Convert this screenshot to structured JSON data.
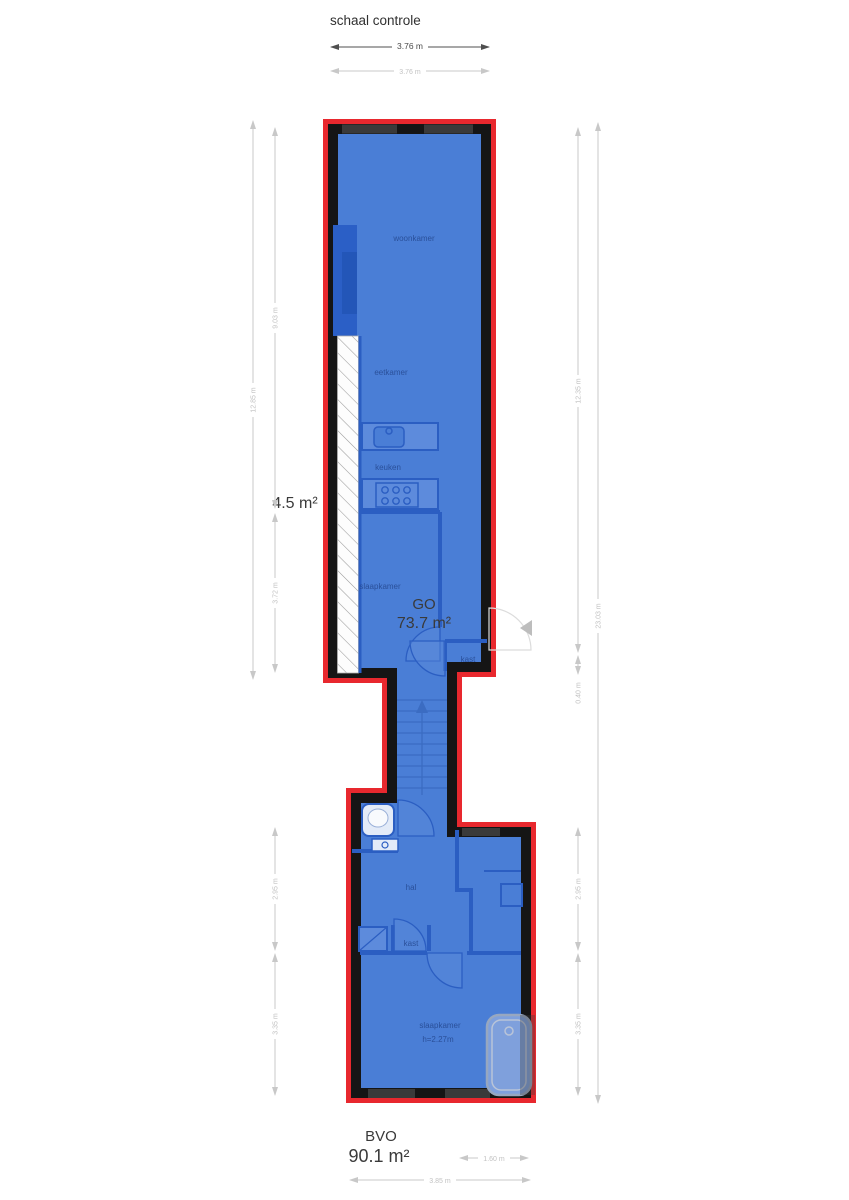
{
  "header": {
    "title": "schaal controle"
  },
  "areas": {
    "void_value": "4.5 m²",
    "go_label": "GO",
    "go_value": "73.7 m²",
    "bvo_label": "BVO",
    "bvo_value": "90.1 m²"
  },
  "rooms": {
    "woonkamer": "woonkamer",
    "eetkamer": "eetkamer",
    "keuken": "keuken",
    "slaapkamer_upper": "slaapkamer",
    "kast_upper": "kast",
    "hal": "hal",
    "kast_lower": "kast",
    "slaapkamer_lower": "slaapkamer",
    "slaapkamer_height": "h=2.27m"
  },
  "dims": {
    "top_primary": "3.76 m",
    "top_secondary": "3.76 m",
    "left_total": "12.85 m",
    "left_upper": "9.03 m",
    "left_lower": "3.72 m",
    "left_low_a": "2.95 m",
    "left_low_b": "3.35 m",
    "right_upper": "12.35 m",
    "right_small": "0.40 m",
    "right_total": "23.03 m",
    "right_low_a": "2.95 m",
    "right_low_b": "3.35 m",
    "bottom_small": "1.60 m",
    "bottom_total": "3.85 m"
  },
  "colors": {
    "outline_red": "#e8282e",
    "wall_black": "#151515",
    "floor_blue": "#4a7ed6",
    "interior_wall_blue": "#2b5ec2",
    "dim_gray": "#c8c8c8",
    "dim_dark": "#4f4f4f"
  }
}
